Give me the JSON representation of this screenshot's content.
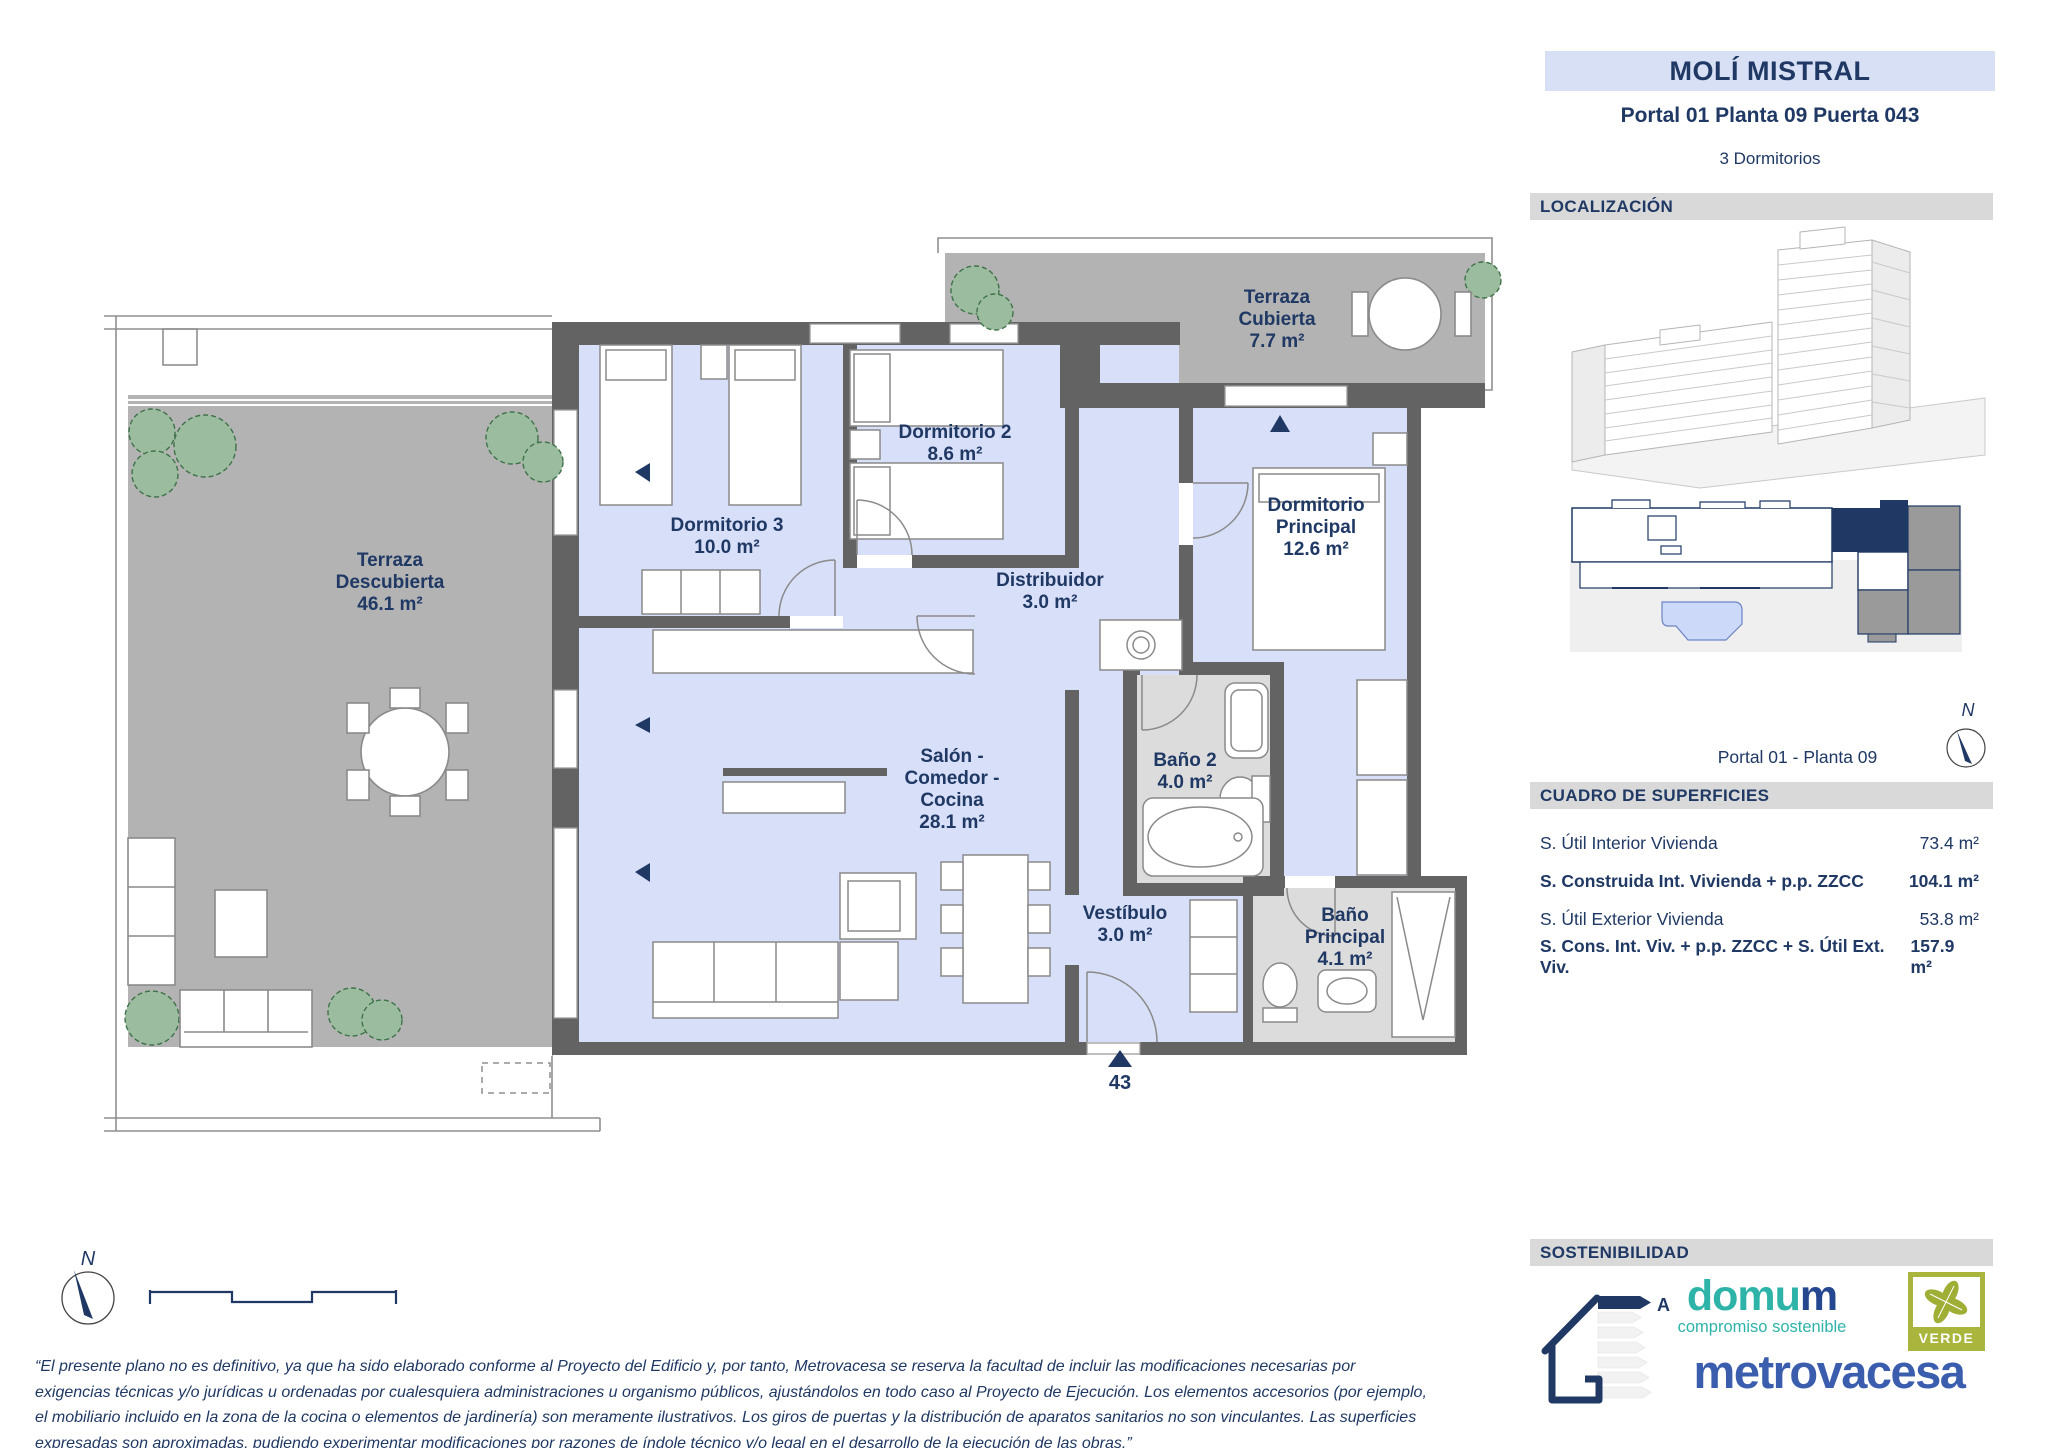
{
  "colors": {
    "navy": "#1f3864",
    "title_band_bg": "#d7e0f4",
    "section_bar_bg": "#d9d9d9",
    "floor_blue": "#d8dff8",
    "wall_gray": "#636363",
    "terrace_gray": "#b3b3b3",
    "bath_gray": "#dcdcdc",
    "plant_green": "#9cbc9f",
    "domum_teal": "#2eb3a9",
    "metrovacesa_blue": "#3b5dad",
    "verde_olive": "#a9b53d",
    "locator_unit_highlight": "#1f3864",
    "locator_unit_gray": "#9a9a9a",
    "locator_pool_blue": "#ccd9f8"
  },
  "header": {
    "project_title": "MOLÍ MISTRAL",
    "unit_reference": "Portal 01 Planta 09 Puerta 043",
    "bedrooms": "3 Dormitorios"
  },
  "localization": {
    "section_title": "LOCALIZACIÓN",
    "caption": "Portal 01 - Planta 09",
    "compass_label": "N"
  },
  "surfaces": {
    "section_title": "CUADRO DE SUPERFICIES",
    "rows": [
      {
        "label": "S. Útil Interior Vivienda",
        "value": "73.4 m²"
      },
      {
        "label": "S. Construida Int. Vivienda + p.p. ZZCC",
        "value": "104.1 m²"
      },
      {
        "label": "S. Útil Exterior Vivienda",
        "value": "53.8 m²"
      },
      {
        "label": "S. Cons. Int. Viv. + p.p. ZZCC + S. Útil Ext. Viv.",
        "value": "157.9 m²"
      }
    ]
  },
  "sustainability": {
    "section_title": "SOSTENIBILIDAD",
    "energy_rating": "A",
    "domum_wordmark_primary": "domu",
    "domum_wordmark_accent": "m",
    "domum_tagline": "compromiso sostenible",
    "verde_label": "VERDE",
    "brand_wordmark": "metrovacesa"
  },
  "plan": {
    "compass_label": "N",
    "door_number": "43",
    "rooms": [
      {
        "id": "terraza-descubierta",
        "name": "Terraza\nDescubierta",
        "area": "46.1 m²"
      },
      {
        "id": "dormitorio-3",
        "name": "Dormitorio 3",
        "area": "10.0 m²"
      },
      {
        "id": "dormitorio-2",
        "name": "Dormitorio 2",
        "area": "8.6 m²"
      },
      {
        "id": "terraza-cubierta",
        "name": "Terraza\nCubierta",
        "area": "7.7 m²"
      },
      {
        "id": "dormitorio-principal",
        "name": "Dormitorio\nPrincipal",
        "area": "12.6 m²"
      },
      {
        "id": "distribuidor",
        "name": "Distribuidor",
        "area": "3.0 m²"
      },
      {
        "id": "salon-comedor-cocina",
        "name": "Salón -\nComedor -\nCocina",
        "area": "28.1 m²"
      },
      {
        "id": "bano-2",
        "name": "Baño 2",
        "area": "4.0 m²"
      },
      {
        "id": "vestibulo",
        "name": "Vestíbulo",
        "area": "3.0 m²"
      },
      {
        "id": "bano-principal",
        "name": "Baño\nPrincipal",
        "area": "4.1 m²"
      }
    ]
  },
  "disclaimer": "“El presente plano no es definitivo, ya que ha sido elaborado conforme al Proyecto del Edificio y, por tanto, Metrovacesa se reserva la facultad de incluir las modificaciones necesarias por exigencias técnicas y/o jurídicas u ordenadas por cualesquiera administraciones u organismo públicos, ajustándolos en todo caso al Proyecto de Ejecución. Los elementos accesorios (por ejemplo, el mobiliario incluido en la zona de la cocina o elementos de jardinería) son meramente ilustrativos. Los giros de puertas y la distribución de aparatos sanitarios no son vinculantes. Las superficies expresadas son aproximadas, pudiendo experimentar modificaciones por razones de índole técnico y/o legal en el desarrollo de la ejecución de las obras.”"
}
